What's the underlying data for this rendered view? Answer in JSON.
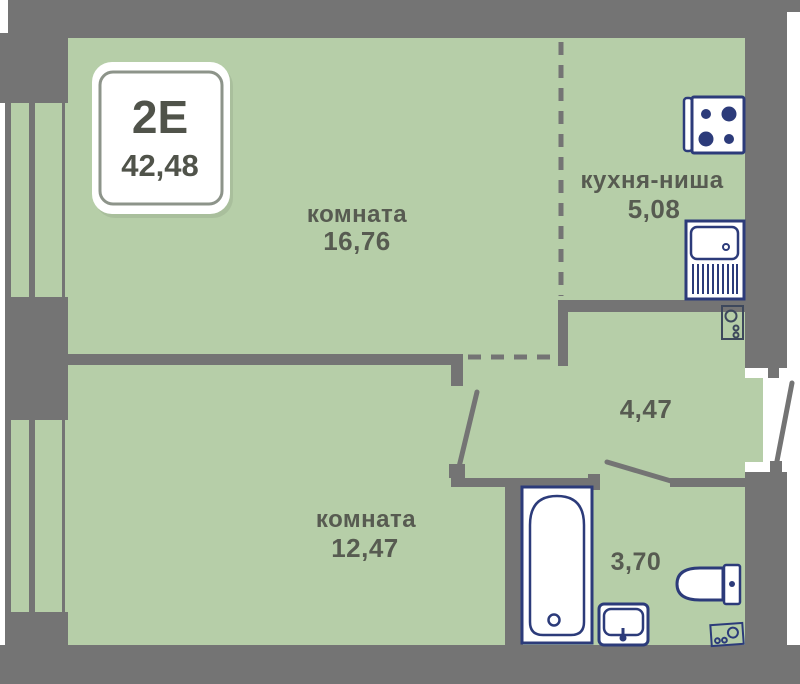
{
  "badge": {
    "type_label": "2Е",
    "total_area": "42,48"
  },
  "rooms": {
    "room1": {
      "name": "комната",
      "area": "16,76"
    },
    "kitchen": {
      "name": "кухня-ниша",
      "area": "5,08"
    },
    "hall": {
      "area": "4,47"
    },
    "room2": {
      "name": "комната",
      "area": "12,47"
    },
    "bathroom": {
      "area": "3,70"
    }
  },
  "icons": {
    "stove": "stove-hob-icon",
    "kitchen_sink": "kitchen-sink-icon",
    "ventilation": "ventilation-riser-icon",
    "bathtub": "bathtub-icon",
    "washbasin": "washbasin-icon",
    "toilet": "toilet-icon",
    "washer": "washing-machine-icon"
  },
  "colors": {
    "floor_green": "#b6cea8",
    "wall_gray": "#747474",
    "fixture_navy": "#2c3b7a",
    "label_text": "#575b51",
    "badge_text": "#50534a"
  }
}
